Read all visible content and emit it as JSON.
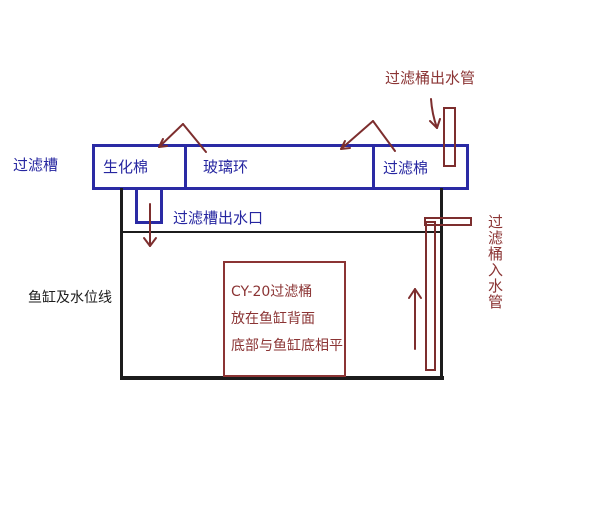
{
  "diagram": {
    "trough": {
      "label": "过滤槽",
      "compartments": [
        "生化棉",
        "玻璃环",
        "过滤棉"
      ],
      "outlet_label": "过滤槽出水口"
    },
    "tank": {
      "label": "鱼缸及水位线"
    },
    "canister_note": {
      "line1": "CY-20过滤桶",
      "line2": "放在鱼缸背面",
      "line3": "底部与鱼缸底相平"
    },
    "pipes": {
      "outlet_label": "过滤桶出水管",
      "inlet_label": "过滤桶入水管"
    },
    "colors": {
      "structure_blue": "#2a2aa4",
      "annotation_maroon": "#8b3434",
      "tank_black": "#1c1c1c",
      "background": "#ffffff"
    }
  }
}
